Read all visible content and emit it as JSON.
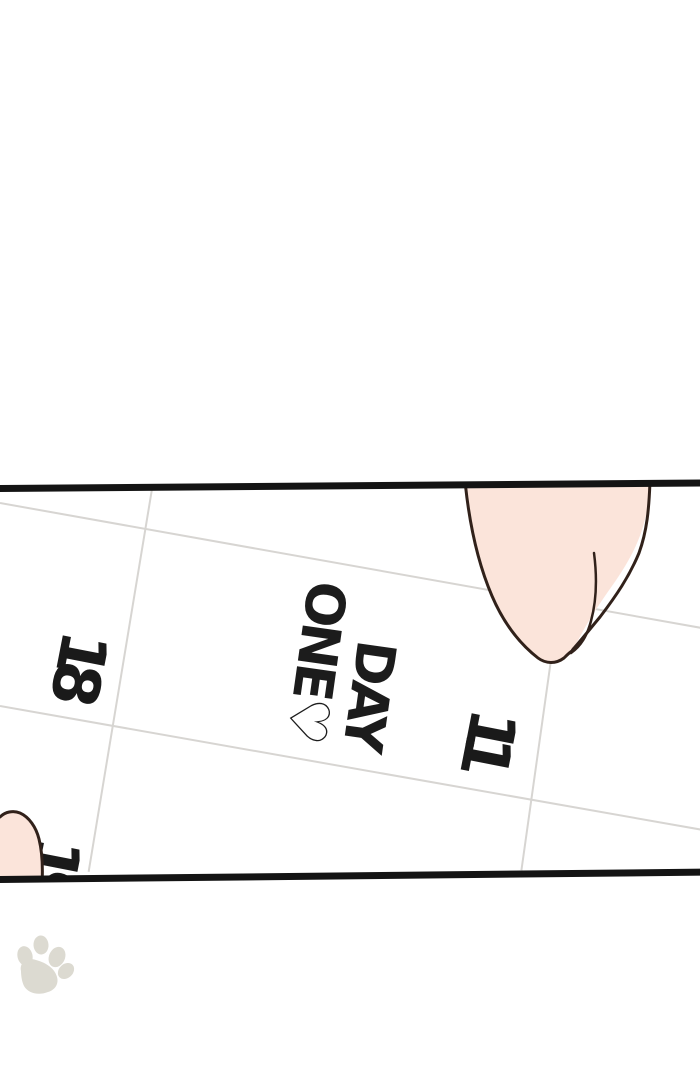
{
  "panel": {
    "kind": "webtoon-comic-panel",
    "border_color": "#141414",
    "background": "#ffffff",
    "calendar": {
      "grid_color": "#d7d5d2",
      "ink_color": "#1a1a1a",
      "dates": [
        {
          "value": "18"
        },
        {
          "value": "11"
        },
        {
          "value": "19"
        }
      ],
      "note": {
        "line1": "DAY",
        "line2": "ONE♡"
      }
    },
    "finger": {
      "skin_color": "#fbe4da",
      "outline_color": "#31211a"
    }
  },
  "footer": {
    "paw_color": "#dcdad1"
  },
  "icons": {
    "pointing_finger": "finger pointing down at calendar date 11",
    "corner_fingertip": "second fingertip entering at bottom-left corner",
    "paw_print": "pale paw print watermark"
  }
}
